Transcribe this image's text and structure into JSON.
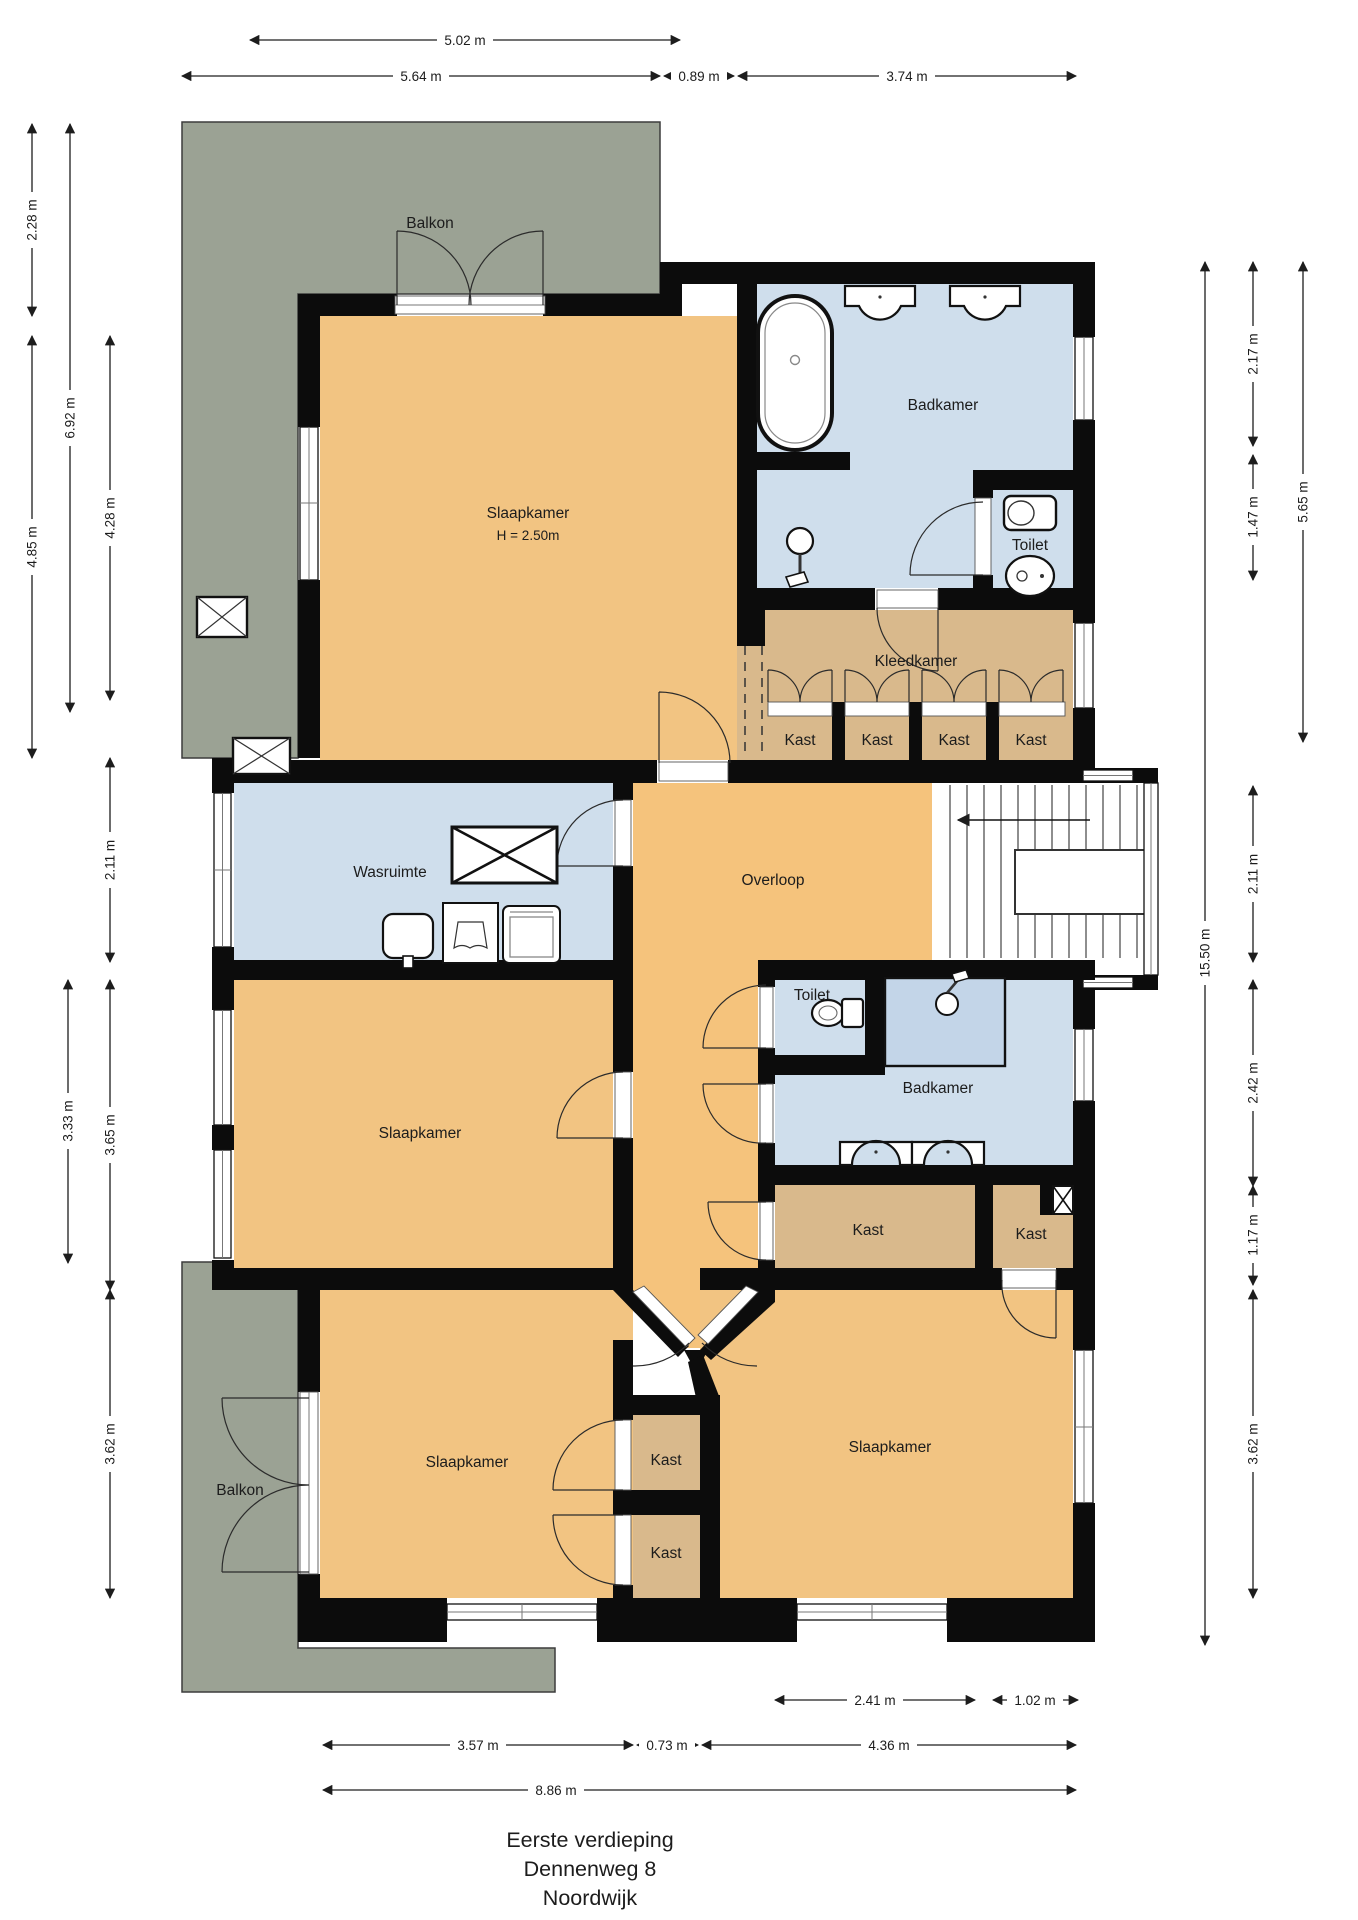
{
  "title": {
    "line1": "Eerste verdieping",
    "line2": "Dennenweg 8",
    "line3": "Noordwijk"
  },
  "rooms": {
    "balkon_top": "Balkon",
    "slaapkamer_nw": "Slaapkamer",
    "slaapkamer_nw_height": "H = 2.50m",
    "badkamer_top": "Badkamer",
    "toilet_top": "Toilet",
    "kleedkamer": "Kleedkamer",
    "kast_a": "Kast",
    "kast_b": "Kast",
    "kast_c": "Kast",
    "kast_d": "Kast",
    "wasruimte": "Wasruimte",
    "overloop": "Overloop",
    "slaapkamer_w": "Slaapkamer",
    "toilet_mid": "Toilet",
    "badkamer_mid": "Badkamer",
    "kast_mid_groot": "Kast",
    "kast_mid_klein": "Kast",
    "balkon_bottom": "Balkon",
    "slaapkamer_sw": "Slaapkamer",
    "kast_sw_boven": "Kast",
    "kast_sw_onder": "Kast",
    "slaapkamer_se": "Slaapkamer"
  },
  "dimensions": {
    "top": [
      "5.02 m",
      "5.64 m",
      "0.89 m",
      "3.74 m"
    ],
    "left": [
      "2.28 m",
      "6.92 m",
      "4.85 m",
      "4.28 m",
      "2.11 m",
      "3.33 m",
      "3.65 m",
      "3.62 m"
    ],
    "right": [
      "2.17 m",
      "5.65 m",
      "1.47 m",
      "2.11 m",
      "15.50 m",
      "2.42 m",
      "1.17 m",
      "3.62 m"
    ],
    "bottom": [
      "2.41 m",
      "1.02 m",
      "3.57 m",
      "0.73 m",
      "4.36 m",
      "8.86 m"
    ]
  },
  "colors": {
    "wall": "#0c0c0c",
    "room_orange": "#f2c482",
    "room_blue": "#cfdeec",
    "room_tan": "#d9b98c",
    "balcony_gray": "#9ba294",
    "background": "#ffffff"
  }
}
